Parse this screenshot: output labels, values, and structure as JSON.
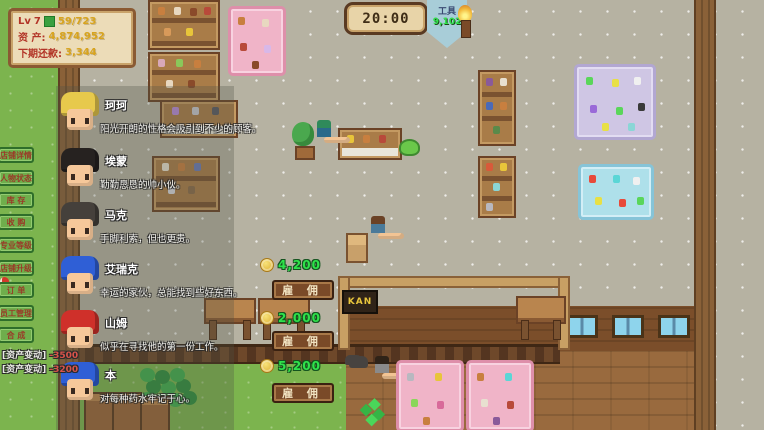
{
  "hud": {
    "level_label": "Lv",
    "level_value": "7",
    "xp_value": "59/723",
    "assets_label": "资 产:",
    "assets_value": "4,874,952",
    "repay_label": "下期还款:",
    "repay_value": "3,344"
  },
  "topbar": {
    "clock": "20:00",
    "tools_label": "工具",
    "tools_value": "9,102"
  },
  "sidebar": {
    "items": [
      "店铺详情",
      "人物状态",
      "库 存",
      "收 购",
      "专业等级",
      "店铺升级",
      "订 单",
      "员工管理",
      "合 成"
    ]
  },
  "hire_panel": {
    "hire_button_label": "雇 佣",
    "characters": [
      {
        "name": "珂珂",
        "desc": "阳光开朗的性格会吸引到不少的顾客。",
        "hair": "#e7c94c",
        "price": ""
      },
      {
        "name": "埃蒙",
        "desc": "勤勤恳恳的帅小伙。",
        "hair": "#262220",
        "price": ""
      },
      {
        "name": "马克",
        "desc": "手脚利索，但也更贵。",
        "hair": "#45403b",
        "price": ""
      },
      {
        "name": "艾瑞克",
        "desc": "幸运的家伙，总能找到些好东西。",
        "hair": "#2f5fd6",
        "price": "4,200"
      },
      {
        "name": "山姆",
        "desc": "似乎在寻找他的第一份工作。",
        "hair": "#cf302a",
        "price": "2,000"
      },
      {
        "name": "本",
        "desc": "对每种药水牢记于心。",
        "hair": "#2f5fd6",
        "price": "5,200"
      }
    ]
  },
  "logs": [
    {
      "label": "[资产变动]",
      "value": "-3500"
    },
    {
      "label": "[资产变动]",
      "value": "-3200"
    }
  ],
  "map": {
    "kan_sign": "KAN"
  },
  "colors": {
    "price_green": "#2fe24b",
    "gold_coin": "#e9c63c",
    "hud_label_red": "#b23427",
    "hud_value_yellow": "#d8a41e",
    "sidebar_tab_green": "#6fae4c",
    "hire_button_brown": "#7a4a28",
    "tools_pennant_blue": "#a8cdd8",
    "grass_green": "#7cb44e"
  }
}
